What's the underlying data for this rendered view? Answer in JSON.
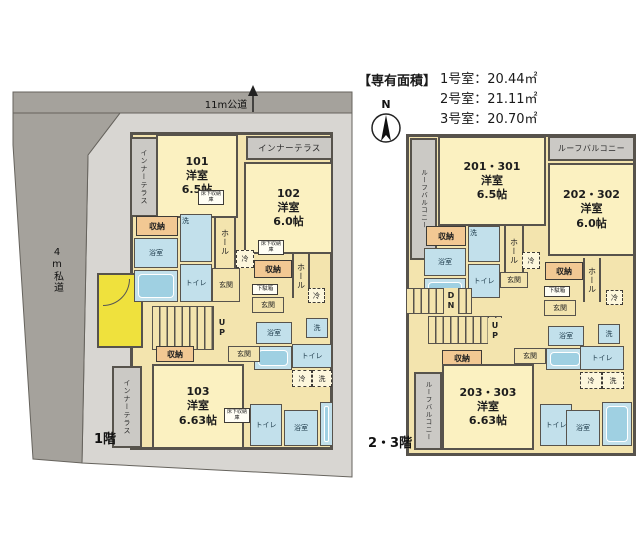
{
  "legend": {
    "title": "【専有面積】",
    "areas": [
      {
        "text": "1号室：20.44㎡"
      },
      {
        "text": "2号室：21.11㎡"
      },
      {
        "text": "3号室：20.70㎡"
      }
    ]
  },
  "compass": {
    "north": "N"
  },
  "roads": {
    "top": "11m公道",
    "left": "4m私道"
  },
  "floors": {
    "first": {
      "label": "1階",
      "units": [
        {
          "no": "101",
          "type": "洋室",
          "size": "6.5帖"
        },
        {
          "no": "102",
          "type": "洋室",
          "size": "6.0帖"
        },
        {
          "no": "103",
          "type": "洋室",
          "size": "6.63帖"
        }
      ]
    },
    "upper": {
      "label": "2・3階",
      "units": [
        {
          "no": "201・301",
          "type": "洋室",
          "size": "6.5帖"
        },
        {
          "no": "202・302",
          "type": "洋室",
          "size": "6.0帖"
        },
        {
          "no": "203・303",
          "type": "洋室",
          "size": "6.63帖"
        }
      ]
    }
  },
  "labels": {
    "closet": "収納",
    "bath": "浴室",
    "toilet": "トイレ",
    "hall": "ホール",
    "fridge": "冷",
    "washer": "洗",
    "entrance": "玄関",
    "shoe_box": "下駄箱",
    "underfloor_storage": "床下収納庫",
    "inner_terrace": "インナーテラス",
    "roof_balcony": "ルーフバルコニー",
    "stairs_up": "UP",
    "stairs_down": "DN"
  },
  "colors": {
    "road": "#a5a29c",
    "lot": "#d8d6d2",
    "wall": "#57534c",
    "room_yellow": "#fbf1c1",
    "hall_tan": "#f3e4ae",
    "wet_blue": "#c2e0eb",
    "fixture_blue": "#9fd0e2",
    "closet_orange": "#f2c893",
    "terrace_gray": "#cbc9c5",
    "porch_yellow": "#efe13d"
  }
}
